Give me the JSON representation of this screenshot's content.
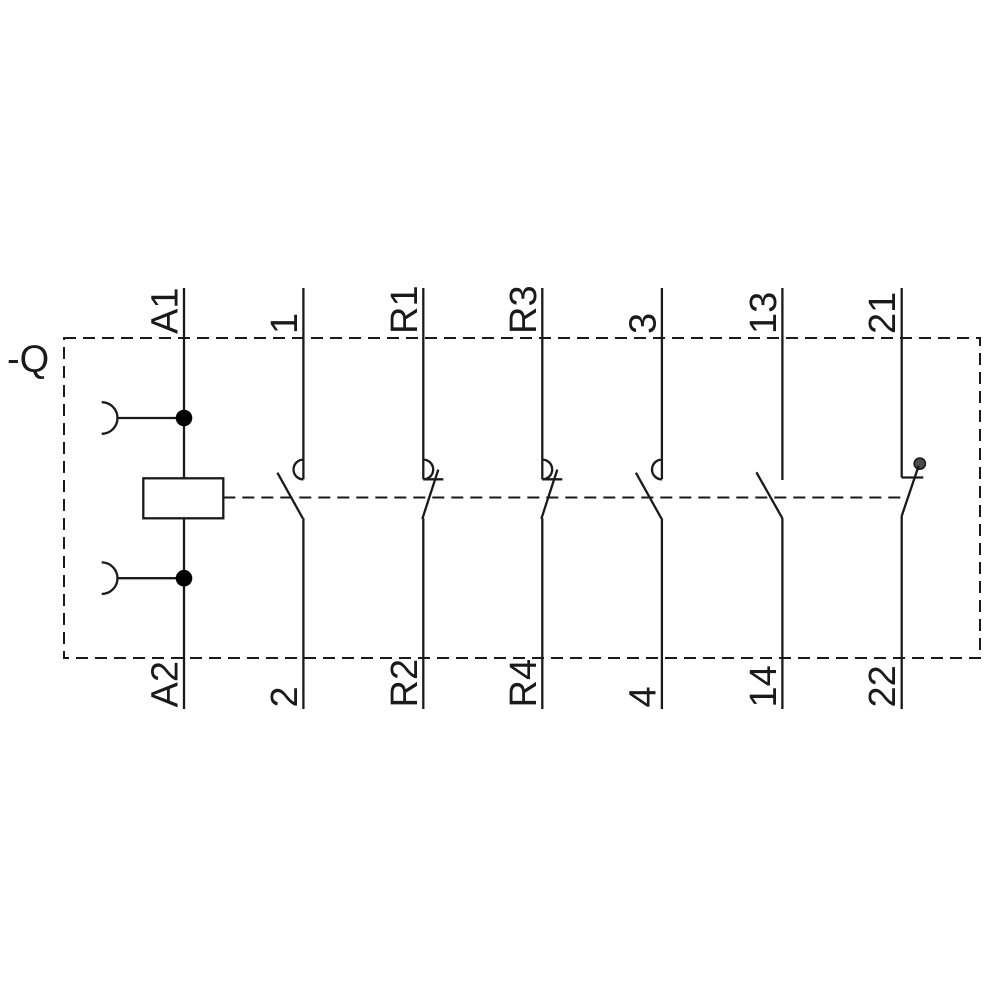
{
  "diagram": {
    "kind": "contactor-relay-circuit-schematic",
    "device_label": "-Q",
    "poles": [
      {
        "id": "coil",
        "symbol": "coil-with-plug-connections",
        "top_terminal": "A1",
        "bottom_terminal": "A2"
      },
      {
        "id": "no-1",
        "symbol": "no-contact-arc-left",
        "top_terminal": "1",
        "bottom_terminal": "2"
      },
      {
        "id": "no-r1",
        "symbol": "no-contact-arc-right",
        "top_terminal": "R1",
        "bottom_terminal": "R2"
      },
      {
        "id": "no-r3",
        "symbol": "no-contact-arc-right",
        "top_terminal": "R3",
        "bottom_terminal": "R4"
      },
      {
        "id": "no-3",
        "symbol": "no-contact-arc-left",
        "top_terminal": "3",
        "bottom_terminal": "4"
      },
      {
        "id": "no-13",
        "symbol": "no-contact-plain",
        "top_terminal": "13",
        "bottom_terminal": "14"
      },
      {
        "id": "nc-21",
        "symbol": "nc-contact-dot",
        "top_terminal": "21",
        "bottom_terminal": "22"
      }
    ],
    "colors": {
      "line": "#1a1a1a",
      "background": "#ffffff",
      "junction_dot": "#000000",
      "nc_contact_dot": "#4d4d4d"
    }
  }
}
